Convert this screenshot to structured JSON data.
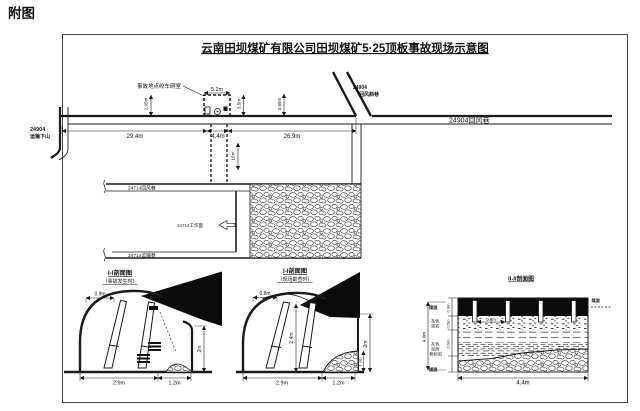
{
  "page_label": "附图",
  "title": "云南田坝煤矿有限公司田坝煤矿5·25顶板事故现场示意图",
  "plan": {
    "accident_label": "事故地点绞车硐室",
    "labels": {
      "dip_no": "24904",
      "dip_name": "运输下山",
      "incline_no": "24904",
      "incline_name": "回风斜巷",
      "return_airway": "24904回风巷",
      "rw_return_24714": "24714回风巷",
      "face_24714": "24714工作面",
      "rw_transport_24714": "24714运输巷"
    },
    "dims": {
      "chamber_width": "5.2m",
      "left_span": "29.4m",
      "chamber_span": "4.4m",
      "right_span": "26.9m",
      "v_left": "2.05m",
      "v_chamber": "3.5m",
      "v_right": "3.65m",
      "v_down": "15m"
    }
  },
  "section1": {
    "title": "I-I剖面图",
    "subtitle": "（事故发生时）",
    "dims": {
      "top": "0.9m",
      "bottom_left": "2.9m",
      "bottom_right": "1.2m",
      "height": "2m"
    }
  },
  "section2": {
    "title": "I-I剖面图",
    "subtitle": "（现场勘查时）",
    "dims": {
      "top": "0.8m",
      "bottom_left": "2.9m",
      "bottom_right": "1.2m",
      "height": "2m",
      "mid_height": "2.4m",
      "debris_height": "1.1m"
    }
  },
  "section3": {
    "title": "II-II剖面图",
    "dims": {
      "post_gap": "0.8m",
      "width": "4.4m",
      "total": "4.0m",
      "layer1": "0.3m",
      "layer2": "0.5m",
      "layer3": "0.9m"
    },
    "labels": {
      "seam_top": "煤层",
      "mid1_l1": "灰色",
      "mid1_l2": "泥岩",
      "mid2_l1": "灰色",
      "mid2_l2": "泥质",
      "mid2_l3": "粉砂岩",
      "seam_bottom": "煤层",
      "seam_right": "煤层"
    }
  },
  "colors": {
    "ink": "#1a1a1a",
    "paper": "#ffffff"
  }
}
